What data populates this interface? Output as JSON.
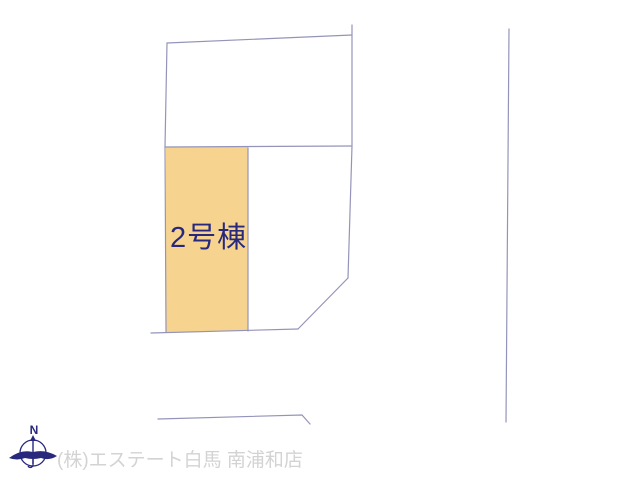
{
  "diagram": {
    "lot_label": "2号棟",
    "compass_label": "N",
    "colors": {
      "lot_fill": "#f6d490",
      "lot_label_color": "#28287d",
      "boundary_line": "#9494ba",
      "compass_color": "#28287d",
      "footer_text_color": "#d3d3d3"
    }
  },
  "footer": {
    "company": "(株)エステート白馬 南浦和店"
  }
}
